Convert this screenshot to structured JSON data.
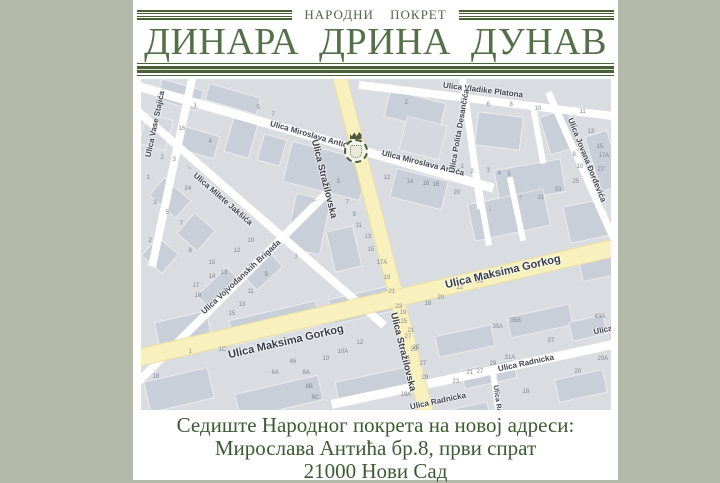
{
  "colors": {
    "page_bg": "#b3baa7",
    "accent_green": "#4a6138",
    "map_bg": "#d9dce1",
    "major_road": "#f8f1bd"
  },
  "header": {
    "subtitle": "НАРОДНИ ПОКРЕТ",
    "title": "ДИНАРА ДРИНА ДУНАВ"
  },
  "footer": {
    "line1": "Седиште Народног покрета на новој адреси:",
    "line2": "Мирослава Антића бр.8, први спрат",
    "line3": "21000 Нови Сад"
  },
  "map": {
    "marker": "movement-crest",
    "street_labels": [
      {
        "text": "Ulica Vase Stajića",
        "x": 14,
        "y": 45,
        "rot": -78
      },
      {
        "text": "Ulica Milete Jakšića",
        "x": 82,
        "y": 120,
        "rot": 41
      },
      {
        "text": "Ulica Miroslava Antića",
        "x": 170,
        "y": 56,
        "rot": 16
      },
      {
        "text": "Ulica Miroslava Antića",
        "x": 282,
        "y": 84,
        "rot": 14
      },
      {
        "text": "Ulica Stražilovska",
        "x": 183,
        "y": 100,
        "rot": 76,
        "size": 9.5,
        "major": true
      },
      {
        "text": "Ulica Stražilovska",
        "x": 262,
        "y": 273,
        "rot": 76,
        "size": 9.5,
        "major": true
      },
      {
        "text": "Ulica Vladike Platona",
        "x": 342,
        "y": 11,
        "rot": 7
      },
      {
        "text": "Ulica Polita Desančića",
        "x": 318,
        "y": 52,
        "rot": -80
      },
      {
        "text": "Ulica Jovana Đorđevića",
        "x": 446,
        "y": 81,
        "rot": 68
      },
      {
        "text": "Ulica Vojvođanskih Brigada",
        "x": 100,
        "y": 198,
        "rot": -43
      },
      {
        "text": "Ulica Maksima Gorkog",
        "x": 145,
        "y": 263,
        "rot": -13,
        "size": 11,
        "major": true
      },
      {
        "text": "Ulica Maksima Gorkog",
        "x": 362,
        "y": 193,
        "rot": -13,
        "size": 11,
        "major": true
      },
      {
        "text": "Ulica Radnicka",
        "x": 385,
        "y": 284,
        "rot": -12
      },
      {
        "text": "Ulica Radnicka",
        "x": 297,
        "y": 322,
        "rot": -12
      },
      {
        "text": "Ulica",
        "x": 462,
        "y": 251,
        "rot": -12
      },
      {
        "text": "Ulica Ra",
        "x": 356,
        "y": 320,
        "rot": 82,
        "size": 7
      }
    ],
    "house_numbers": [
      [
        "1",
        53,
        24
      ],
      [
        "5",
        116,
        26
      ],
      [
        "7",
        131,
        33
      ],
      [
        "16",
        38,
        47
      ],
      [
        "2",
        20,
        76
      ],
      [
        "3",
        32,
        78
      ],
      [
        "4",
        68,
        60
      ],
      [
        "1",
        6,
        96
      ],
      [
        "24",
        44,
        107
      ],
      [
        "3",
        13,
        121
      ],
      [
        "5",
        25,
        131
      ],
      [
        "7",
        39,
        142
      ],
      [
        "2",
        8,
        159
      ],
      [
        "8",
        48,
        169
      ],
      [
        "15",
        68,
        181
      ],
      [
        "13",
        80,
        191
      ],
      [
        "17",
        52,
        204
      ],
      [
        "18",
        12,
        295
      ],
      [
        "1C",
        78,
        268
      ],
      [
        "1",
        48,
        270
      ],
      [
        "3",
        196,
        100
      ],
      [
        "7",
        205,
        121
      ],
      [
        "9",
        212,
        133
      ],
      [
        "11",
        215,
        144
      ],
      [
        "13",
        224,
        155
      ],
      [
        "15",
        227,
        168
      ],
      [
        "17A",
        236,
        181
      ],
      [
        "19",
        243,
        196
      ],
      [
        "21",
        248,
        210
      ],
      [
        "23",
        255,
        225
      ],
      [
        "25",
        260,
        240
      ],
      [
        "27",
        264,
        255
      ],
      [
        "29",
        270,
        268
      ],
      [
        "2",
        264,
        21
      ],
      [
        "6",
        346,
        23
      ],
      [
        "8",
        369,
        23
      ],
      [
        "10",
        394,
        27
      ],
      [
        "11",
        439,
        30
      ],
      [
        "13",
        447,
        50
      ],
      [
        "15",
        456,
        65
      ],
      [
        "17A",
        458,
        74
      ],
      [
        "8",
        432,
        73
      ],
      [
        "10",
        436,
        85
      ],
      [
        "27",
        457,
        88
      ],
      [
        "25",
        432,
        100
      ],
      [
        "1",
        320,
        85
      ],
      [
        "2",
        330,
        90
      ],
      [
        "3",
        346,
        89
      ],
      [
        "4",
        357,
        92
      ],
      [
        "5",
        367,
        93
      ],
      [
        "12",
        243,
        96
      ],
      [
        "14",
        266,
        100
      ],
      [
        "16",
        282,
        102
      ],
      [
        "18",
        292,
        103
      ],
      [
        "20",
        313,
        111
      ],
      [
        "31",
        397,
        116
      ],
      [
        "33",
        414,
        108
      ],
      [
        "35A",
        352,
        245
      ],
      [
        "35B",
        370,
        239
      ],
      [
        "31A",
        364,
        276
      ],
      [
        "29",
        349,
        282
      ],
      [
        "27",
        336,
        290
      ],
      [
        "21",
        326,
        291
      ],
      [
        "23",
        312,
        300
      ],
      [
        "22",
        316,
        206
      ],
      [
        "24",
        336,
        200
      ],
      [
        "26",
        356,
        192
      ],
      [
        "20",
        297,
        216
      ],
      [
        "18",
        284,
        222
      ],
      [
        "19",
        259,
        231
      ],
      [
        "21",
        267,
        249
      ],
      [
        "25",
        272,
        266
      ],
      [
        "27",
        279,
        282
      ],
      [
        "29",
        281,
        296
      ],
      [
        "19A",
        260,
        313
      ],
      [
        "37",
        407,
        259
      ],
      [
        "43A",
        454,
        235
      ],
      [
        "20A",
        457,
        277
      ],
      [
        "20",
        434,
        290
      ],
      [
        "18",
        382,
        310
      ],
      [
        "10",
        107,
        159
      ],
      [
        "12",
        93,
        169
      ],
      [
        "14",
        68,
        195
      ],
      [
        "16",
        54,
        214
      ],
      [
        "7",
        154,
        176
      ],
      [
        "9",
        124,
        193
      ],
      [
        "11",
        107,
        210
      ],
      [
        "13",
        98,
        223
      ],
      [
        "15",
        88,
        232
      ],
      [
        "12",
        216,
        261
      ],
      [
        "10A",
        197,
        270
      ],
      [
        "10",
        182,
        277
      ],
      [
        "6A",
        131,
        291
      ],
      [
        "8A",
        162,
        291
      ],
      [
        "8B",
        165,
        305
      ],
      [
        "8C",
        171,
        316
      ],
      [
        "46",
        149,
        280
      ]
    ],
    "arrows": [
      {
        "g": "→",
        "x": 44,
        "y": 82,
        "rot": 41
      },
      {
        "g": "→",
        "x": 170,
        "y": 118,
        "rot": 160
      },
      {
        "g": "→",
        "x": 374,
        "y": 114,
        "rot": -95
      },
      {
        "g": "→",
        "x": 346,
        "y": 124,
        "rot": 85
      }
    ]
  }
}
